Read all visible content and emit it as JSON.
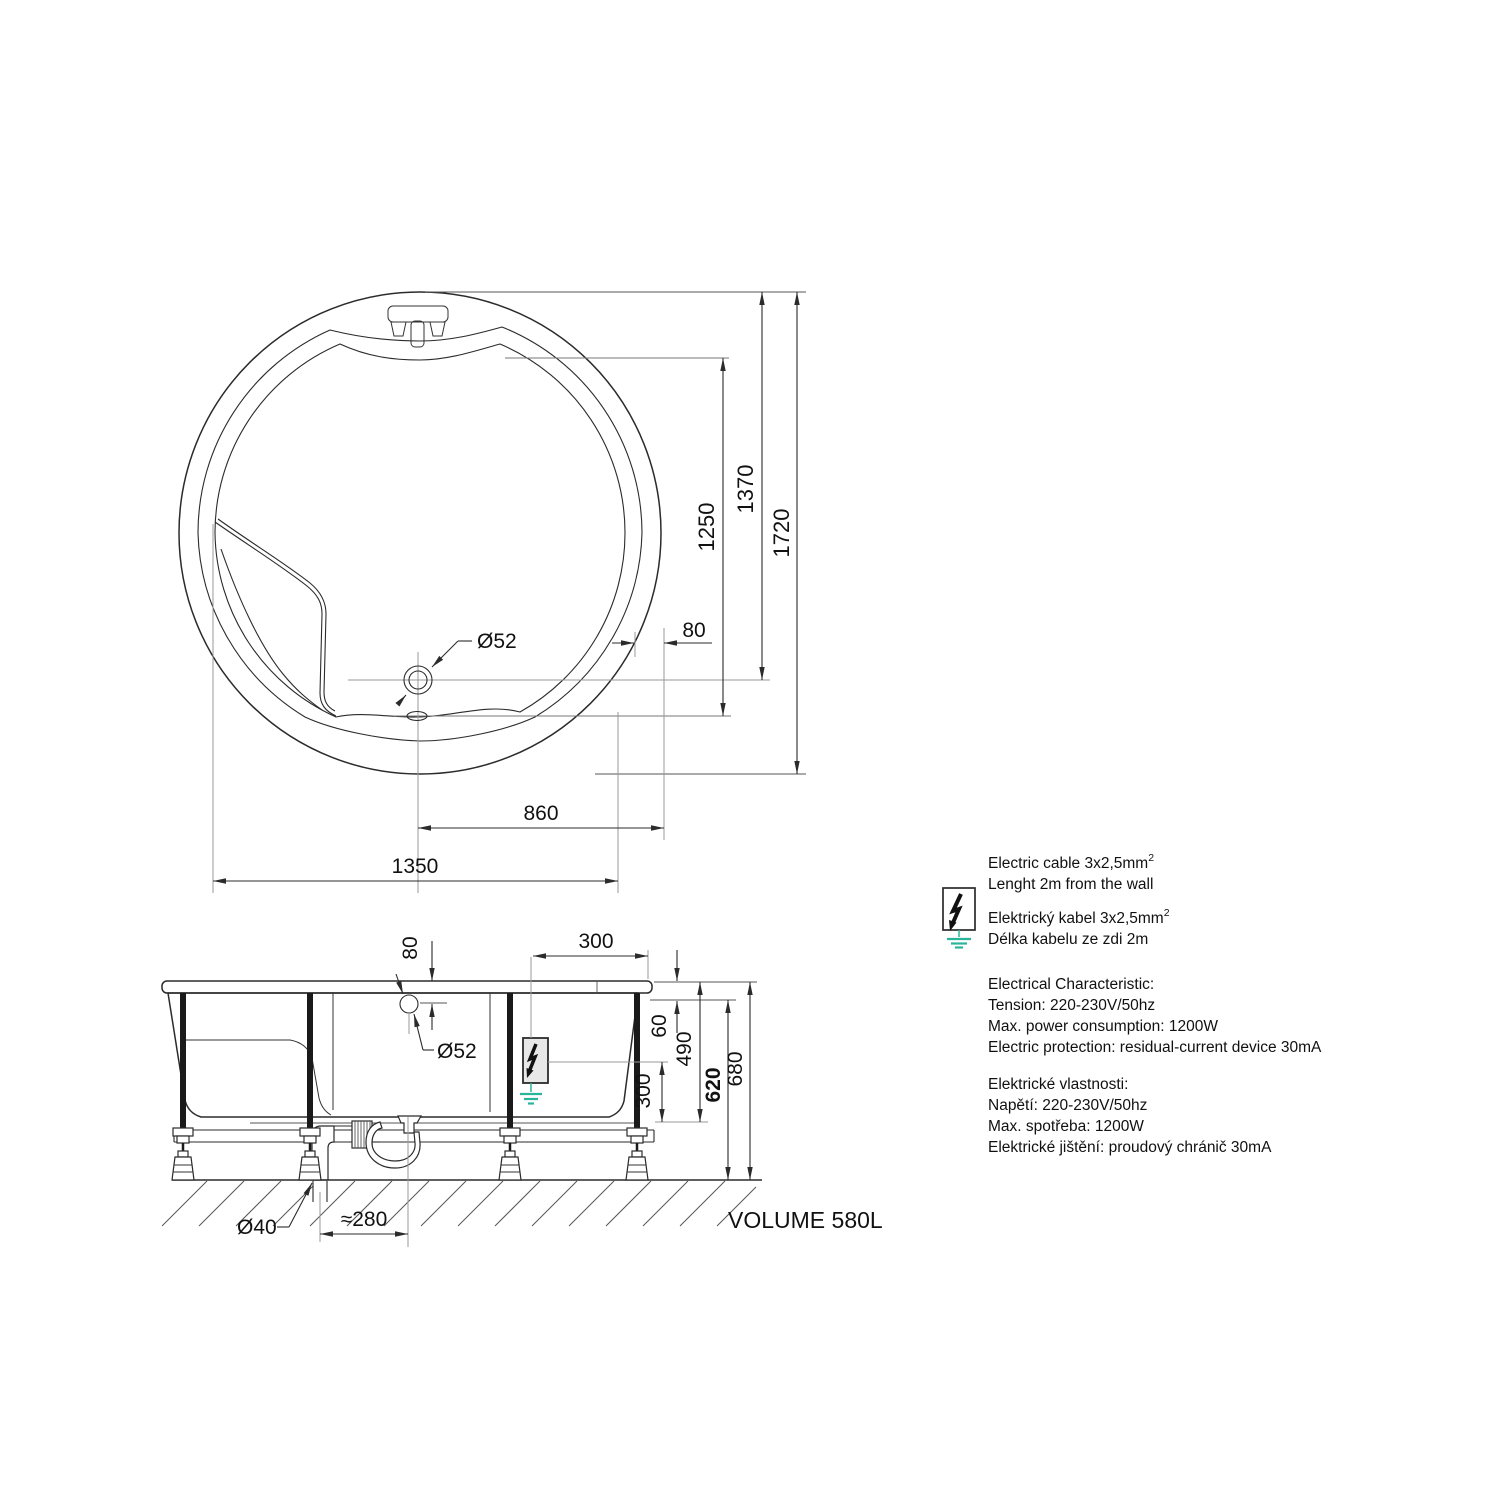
{
  "colors": {
    "tub_fill": "#e8e8e8",
    "fixture_fill": "#c9c9c9",
    "line": "#2b2b2b",
    "aux_line": "#999999",
    "ground_green": "#2ab49a"
  },
  "top_view": {
    "dim_overall_diameter": "1720",
    "dim_rim_to_drain": "1370",
    "dim_basin_length": "1250",
    "dim_rim_width": "80",
    "dim_drain_to_edge": "860",
    "dim_seat_width": "1350",
    "drain_diameter_label": "Ø52"
  },
  "side_view": {
    "dim_hole_offset": "80",
    "dim_box_to_edge": "300",
    "drain_diameter_label": "Ø52",
    "dim_rim_to_flange": "60",
    "dim_rim_to_cable": "490",
    "dim_cable_to_frame": "300",
    "dim_frame_height": "620",
    "dim_total_height": "680",
    "waste_pipe_label": "Ø40",
    "dim_trap_offset": "≈280",
    "volume_label": "VOLUME 580L"
  },
  "notes": {
    "superscript": "2",
    "en_cable_line1": "Electric cable 3x2,5mm",
    "en_cable_line2": "Lenght 2m from the wall",
    "cz_cable_line1": "Elektrický kabel 3x2,5mm",
    "cz_cable_line2": "Délka kabelu ze zdi 2m",
    "en_spec_title": "Electrical Characteristic:",
    "en_spec_tension": "Tension: 220-230V/50hz",
    "en_spec_power": "Max. power consumption: 1200W",
    "en_spec_protection": "Electric protection: residual-current device 30mA",
    "cz_spec_title": "Elektrické vlastnosti:",
    "cz_spec_tension": "Napětí: 220-230V/50hz",
    "cz_spec_power": "Max. spotřeba: 1200W",
    "cz_spec_protection": "Elektrické jištění: proudový chránič 30mA"
  }
}
